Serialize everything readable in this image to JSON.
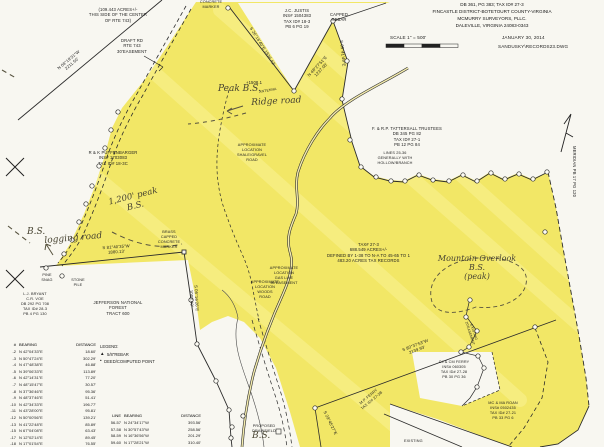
{
  "colors": {
    "highlight": "#f2e766",
    "highlight_light": "#faf398",
    "paper": "#f8f7f1",
    "ink": "#1d1d1d",
    "pen": "#474331"
  },
  "title_block": {
    "line1": "DB 361, PG 383; TAX ID# 27-3",
    "line2": "FINCASTLE DISTRICT-BOTETOURT COUNTY-VIRGINIA",
    "line3": "MCMURRY SURVEYORS, PLLC.",
    "line4": "DALEVILLE, VIRGINIA 24083-0343",
    "scale": "SCALE 1\" = 500'",
    "date": "JANUARY 30, 2014",
    "file": "SANDUSKY\\RECORDS23.DWG"
  },
  "notes": {
    "acreage": "(109.443 ACRES+/-\nTHIS SIDE OF THE CENTER\nOF RTE 743)",
    "draft_rd": "DRAFT RD\nRTE 743\n30'EASEMENT",
    "parcel": "TAX# 27-3\n688.549 ACRES+/-\nDEFINED BY 1-38 TO N-A TO 45-65 TO 1\n483.20 ACRES TAX RECORDS",
    "lines_note": "LINES 25-36\nGENERALLY WITH\nHOLLOW/BRANCH",
    "gas_line": "APPROXIMATE\nLOCATION\nGAS LINE\n50'EASEMENT",
    "shale_road": "APPROXIMATE\nLOCATION\nSHALE/GRAVEL\nROAD",
    "woods_road": "APPROXIMATE\nLOCATION\nWOODS\nROAD"
  },
  "owners": {
    "justis": "J.C. JUSTIS\nINS# 1504383\nTAX ID# 18-3\nPB 6 PG 19",
    "tattersall": "F. & R.P. TATTERSALL TRUSTEES\nDB 345 PG 82\nTAX ID# 27-1\nPB 12 PG 84",
    "puffenbarger": "R & K PUFFENBARGER\nINS# 1703083\nTAX ID# 18-3C",
    "bryant": "L.J. BRYANT\nC.R. VOE\nDB 292 PG 708\nTAX ID# 28-3\nPB 4 PG 130",
    "jnf": "JEFFERSON NATIONAL\nFOREST\nTRACT 600",
    "cj_ferry": "CJ & CM FERRY\nINS# 060305\nTAX ID# 27-28\nPB 30 PG 36",
    "roan": "MC & MA ROAN\nINS# 0502435\nTAX ID# 27-21\nPB 33 PG 6",
    "mp_ferry": "M.P. FERRY\nTAX ID# 27-3B"
  },
  "markers": {
    "concrete_marker": "CONCRETE\nMARKER",
    "capped_rebar": "CAPPED\nREBAR",
    "brass_marker": "BRASS\nCAPPED\nCONCRETE\nMARKER",
    "pine_snag": "PINE\nSNAG",
    "stone_pile": "STONE\nPILE",
    "elevation": "+1508.1",
    "antenna": "ANTENNA",
    "drainfield": "PROPOSED\nDRAINFIELD",
    "existing": "EXISTING",
    "existing_easement": "EXISTING\n20'EASEMENT",
    "meridian": "MERIDIAN  PB 17 PG 120"
  },
  "handwritten": {
    "peak_bs": "Peak B.S.",
    "ridge_road": "Ridge road",
    "bs_1200": "1,200' peak\nB.S.",
    "bs_left": "B.S.",
    "logging_road": "logging road",
    "mountain_overlook": "Mountain Overlook\nB.S.\n(peak)",
    "bs_bottom": "B.S."
  },
  "bearings": {
    "left_line": "N 08°19'31\"W\n2211.50'",
    "notch_left": "S 26°16'40\"E  1536.42'",
    "notch_right": "N 48°27'51\"E\n1237.05'",
    "rebar_south": "S 05°41'49\"E",
    "logging": "S 81°40'35\"W\n1880.13'",
    "jnf_east": "S 05°16'26\"E\n1008.40'",
    "long_south": "S 80°37'53\"W\n2139.93'",
    "se_short": "S 29°45'27\"E"
  },
  "legend": {
    "title": "LEGEND:",
    "items": [
      {
        "symbol": "▲",
        "label": "5/8\"REBAR"
      },
      {
        "symbol": "•",
        "label": "DEED/COMPUTED POINT"
      }
    ]
  },
  "tables": {
    "traverse": {
      "headers": [
        "#",
        "BEARING",
        "DISTANCE"
      ],
      "rows": [
        [
          "-2",
          "N 42°04'33\"E",
          "18.60'"
        ],
        [
          "-3",
          "N 50°47'24\"E",
          "302.29'"
        ],
        [
          "-4",
          "N 47°48'38\"E",
          "46.88'"
        ],
        [
          "-5",
          "N 39°06'33\"E",
          "113.89'"
        ],
        [
          "-6",
          "N 42°14'31\"E",
          "77.20'"
        ],
        [
          "-7",
          "N 48°15'47\"E",
          "30.57'"
        ],
        [
          "-8",
          "N 37°36'46\"E",
          "95.36'"
        ],
        [
          "-9",
          "N 48°37'46\"E",
          "51.41'"
        ],
        [
          "-10",
          "N 42°34'33\"E",
          "196.77'"
        ],
        [
          "-11",
          "N 43°28'00\"E",
          "95.81'"
        ],
        [
          "-12",
          "N 50°00'56\"E",
          "139.21'"
        ],
        [
          "-13",
          "N 41°22'48\"E",
          "85.89'"
        ],
        [
          "-15",
          "N 67°04'08\"E",
          "63.43'"
        ],
        [
          "-17",
          "N 12°02'14\"E",
          "89.45'"
        ],
        [
          "-18",
          "N 17°01'54\"E",
          "76.55'"
        ],
        [
          "-19",
          "N 38°04'31\"E",
          "79.38'"
        ]
      ]
    },
    "lines": {
      "headers": [
        "LINE",
        "BEARING",
        "DISTANCE"
      ],
      "rows": [
        [
          "56-57",
          "N 24°34'17\"W",
          "393.56'"
        ],
        [
          "57-58",
          "N 30°57'43\"W",
          "258.56'"
        ],
        [
          "58-59",
          "N 16°36'56\"W",
          "201.29'"
        ],
        [
          "59-60",
          "N 17°28'21\"W",
          "310.40'"
        ]
      ]
    }
  }
}
